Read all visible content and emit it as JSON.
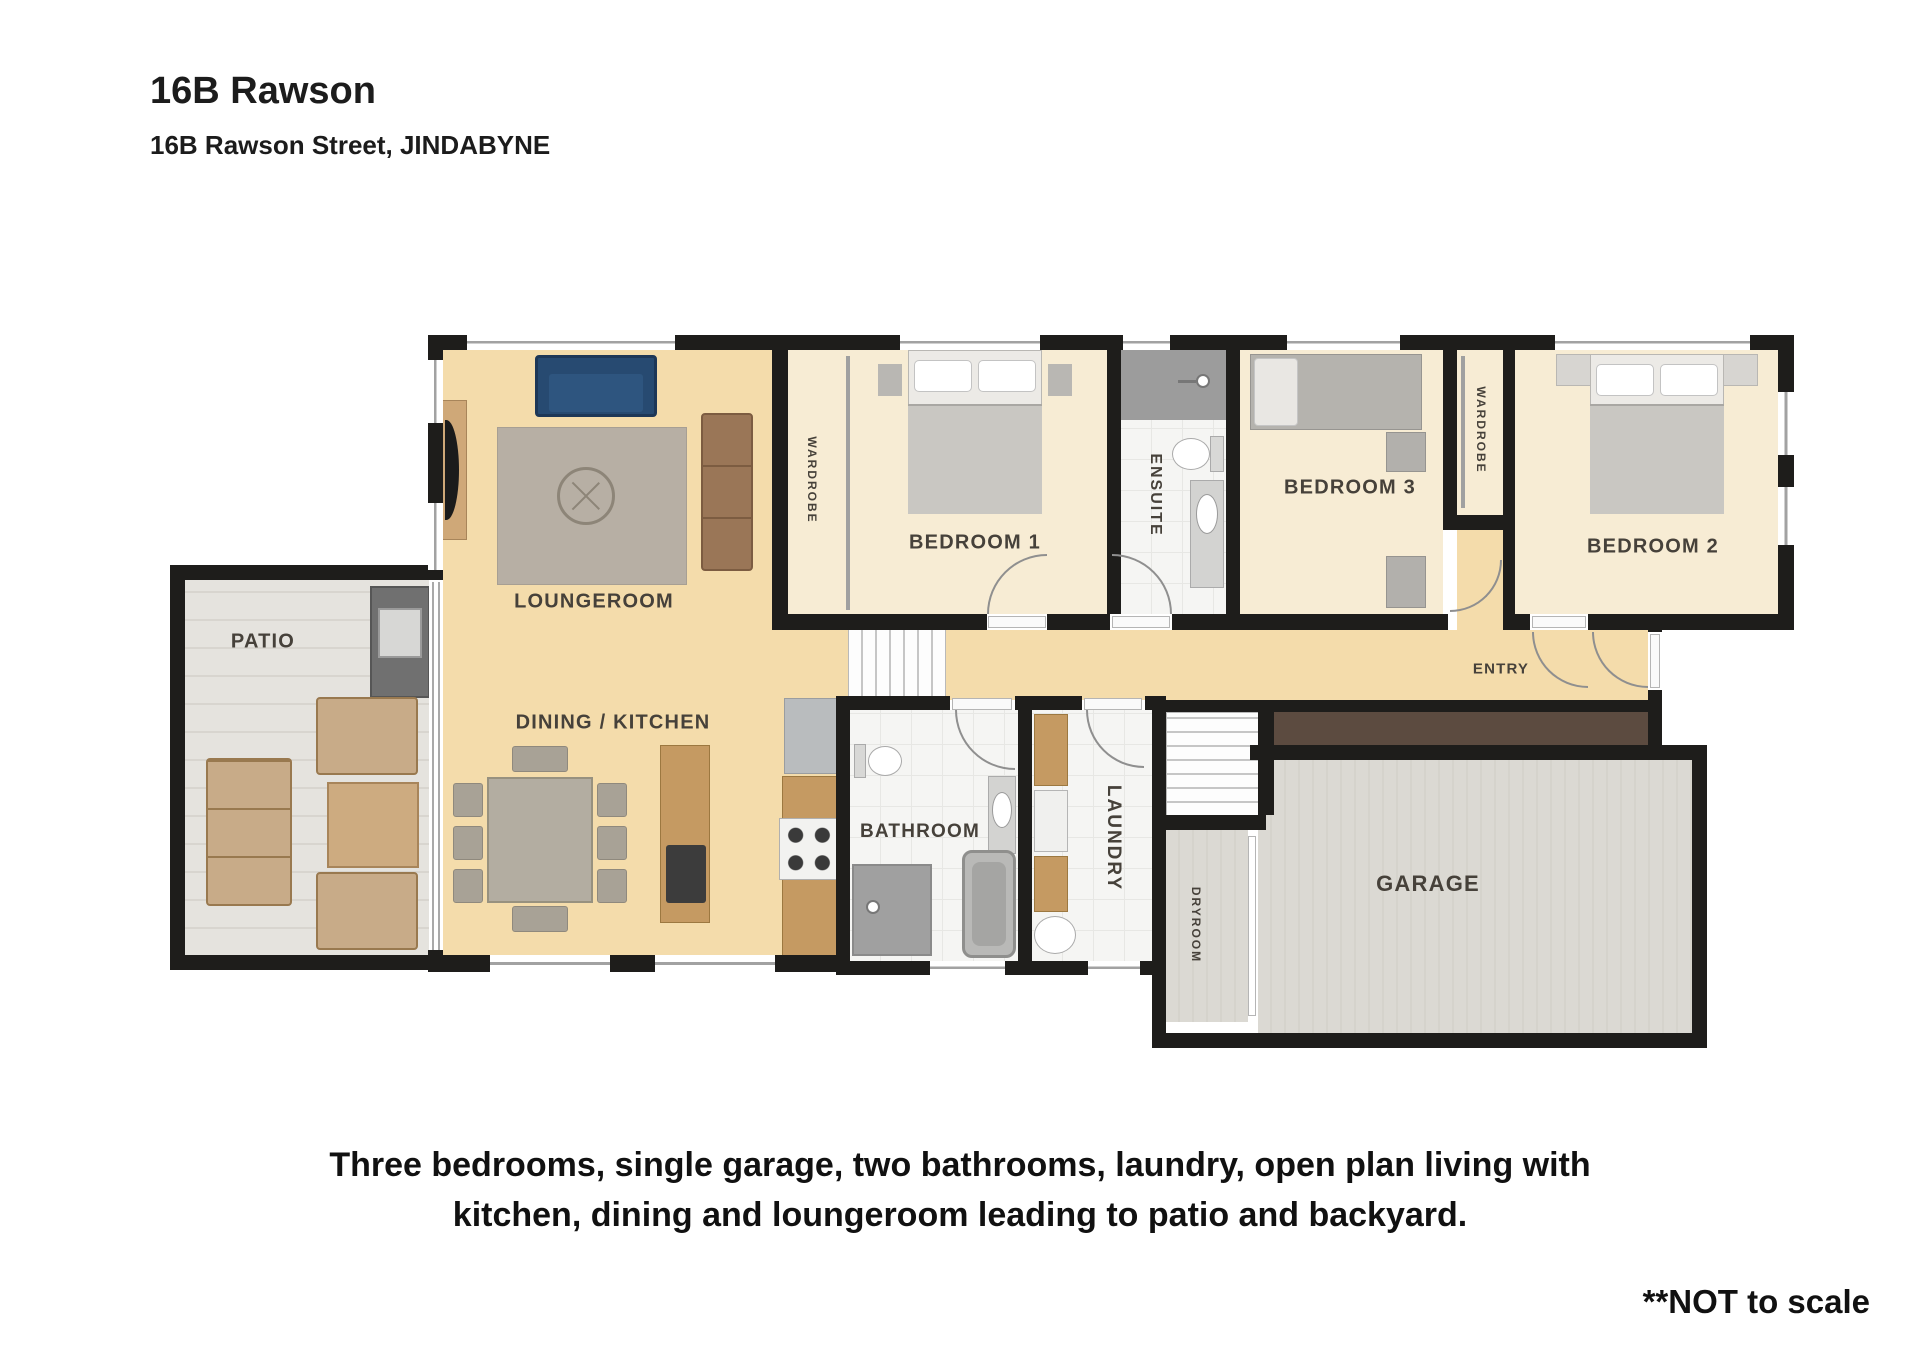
{
  "header": {
    "title": "16B Rawson",
    "subtitle": "16B Rawson Street, JINDABYNE"
  },
  "rooms": {
    "patio": "PATIO",
    "loungeroom": "LOUNGEROOM",
    "dining_kitchen": "DINING / KITCHEN",
    "bedroom1": "BEDROOM 1",
    "bedroom2": "BEDROOM 2",
    "bedroom3": "BEDROOM 3",
    "ensuite": "ENSUITE",
    "bathroom": "BATHROOM",
    "laundry": "LAUNDRY",
    "entry": "ENTRY",
    "garage": "GARAGE",
    "dryroom": "DRYROOM",
    "wardrobe_bed1": "WARDROBE",
    "wardrobe_bed2": "WARDROBE"
  },
  "footer": {
    "description_line1": "Three bedrooms, single garage, two bathrooms, laundry, open plan living with",
    "description_line2": "kitchen, dining and loungeroom leading to patio and backyard.",
    "scale_note": "**NOT to scale"
  },
  "colors": {
    "wall": "#1e1d1b",
    "floor-tan": "#f4dcab",
    "floor-cream": "#f7ecd4",
    "floor-wet": "#f5f5f3",
    "floor-patio": "#e5e3de",
    "floor-garage": "#dbd9d3",
    "wood": "#c59a62",
    "deck-brown": "#5c4b40",
    "sofa-blue": "#274a71",
    "sofa-brown": "#9a7657",
    "rug": "#b7afa4",
    "label": "#46413a"
  }
}
